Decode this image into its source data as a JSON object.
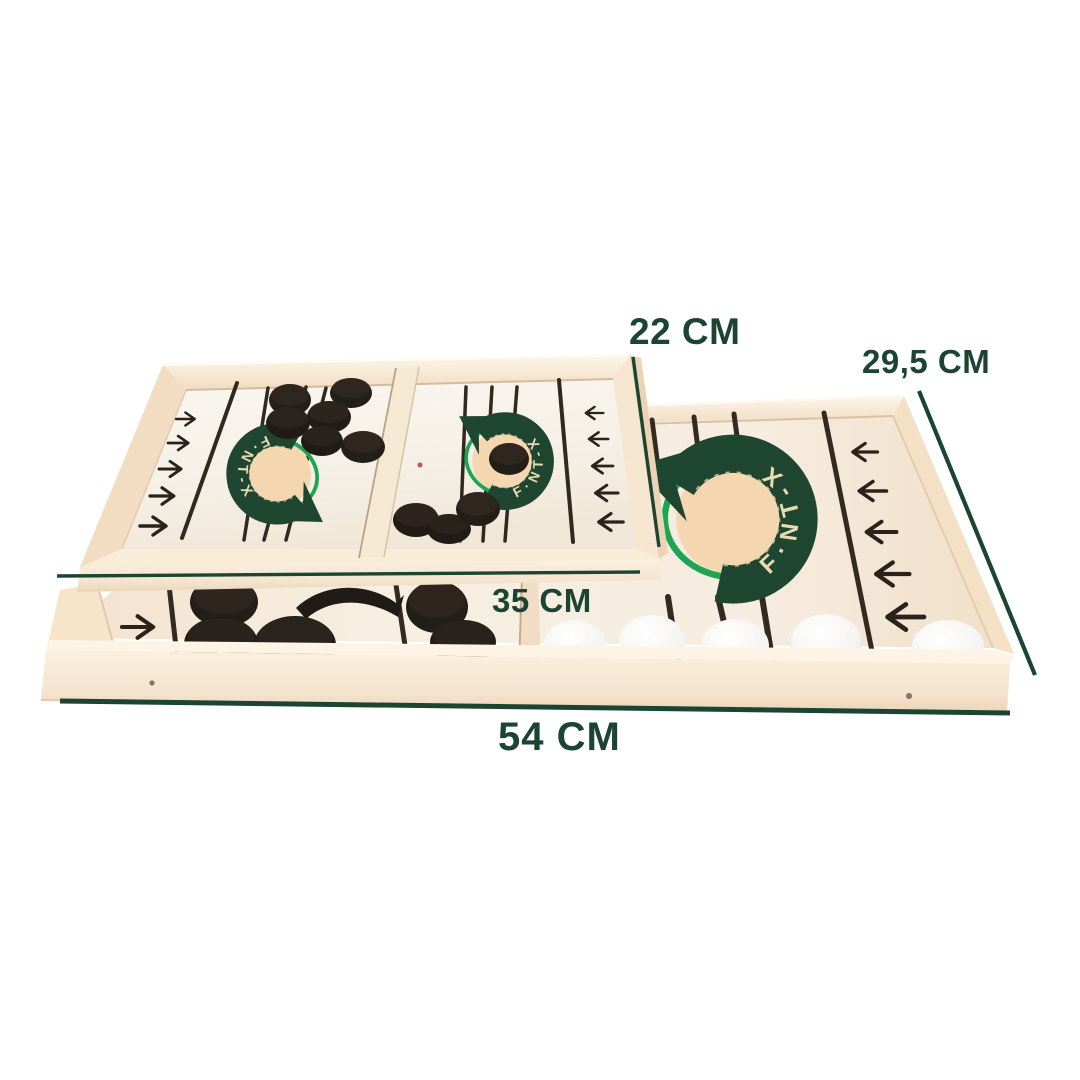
{
  "annotations": {
    "small_board_width": {
      "label": "22 CM"
    },
    "large_board_width": {
      "label": "29,5 CM"
    },
    "small_board_length": {
      "label": "35 CM"
    },
    "large_board_length": {
      "label": "54 CM"
    }
  },
  "logo": {
    "text": "F·NT-X"
  },
  "colors": {
    "annotation_green": "#1b4433",
    "logo_band_green": "#1f4630",
    "logo_ring_green": "#1ca653",
    "logo_letter_cream": "#e7dbb2",
    "logo_circle_cream": "#f4d6b0",
    "wood_light": "#f9eddb",
    "wood_shadow": "#e9d2b6",
    "surface_offwhite": "#f6f2ea",
    "lane_line_dark": "#30291f",
    "puck_black": "#241e19",
    "puck_white": "#f5f4f1"
  }
}
